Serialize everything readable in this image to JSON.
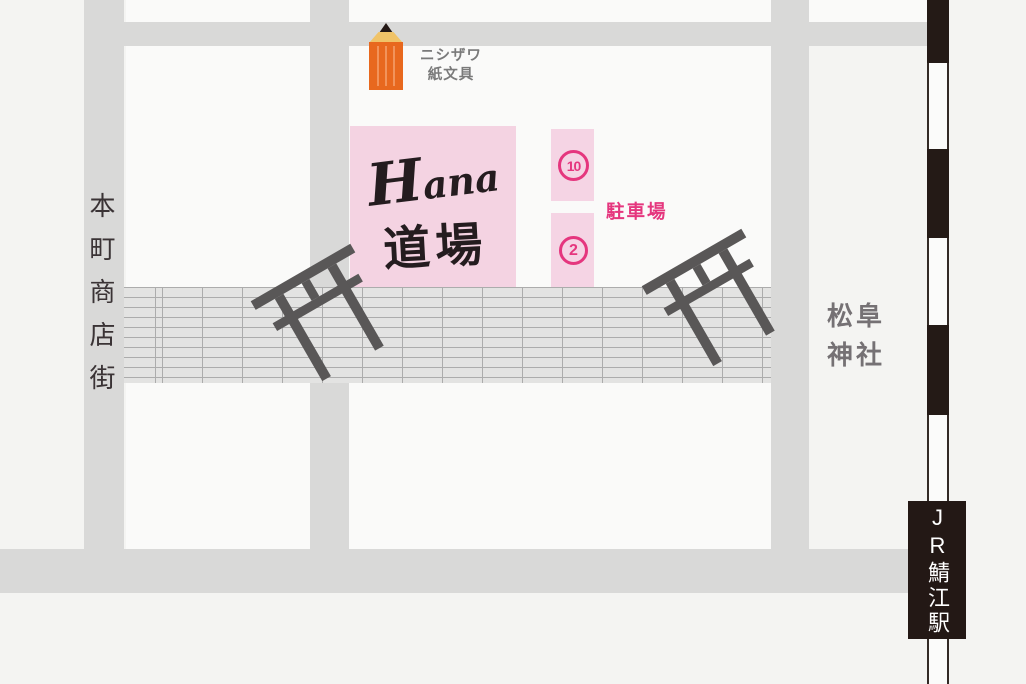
{
  "map": {
    "type": "access-map",
    "labels": {
      "shopping_street": "本町商店街",
      "stationery_line1": "ニシザワ",
      "stationery_line2": "紙文具",
      "dojo_latin": "Hana",
      "dojo_kanji": "道場",
      "parking": "駐車場",
      "stall_top": "10",
      "stall_bottom": "2",
      "shrine_line1": "松阜",
      "shrine_line2": "神社",
      "station": "JR鯖江駅"
    },
    "colors": {
      "background": "#f4f4f2",
      "block": "#fafaf9",
      "road": "#d9d9d8",
      "arcade_bg": "#e3e3e2",
      "arcade_line": "#acacac",
      "pink_block": "#f5d4e4",
      "pink_accent": "#e5367e",
      "pencil_orange": "#e8681e",
      "pencil_wood": "#f0c368",
      "ink_black": "#231815",
      "torii_gray": "#595757",
      "street_text": "#3a3335",
      "gray_text": "#7a7a7a"
    }
  }
}
